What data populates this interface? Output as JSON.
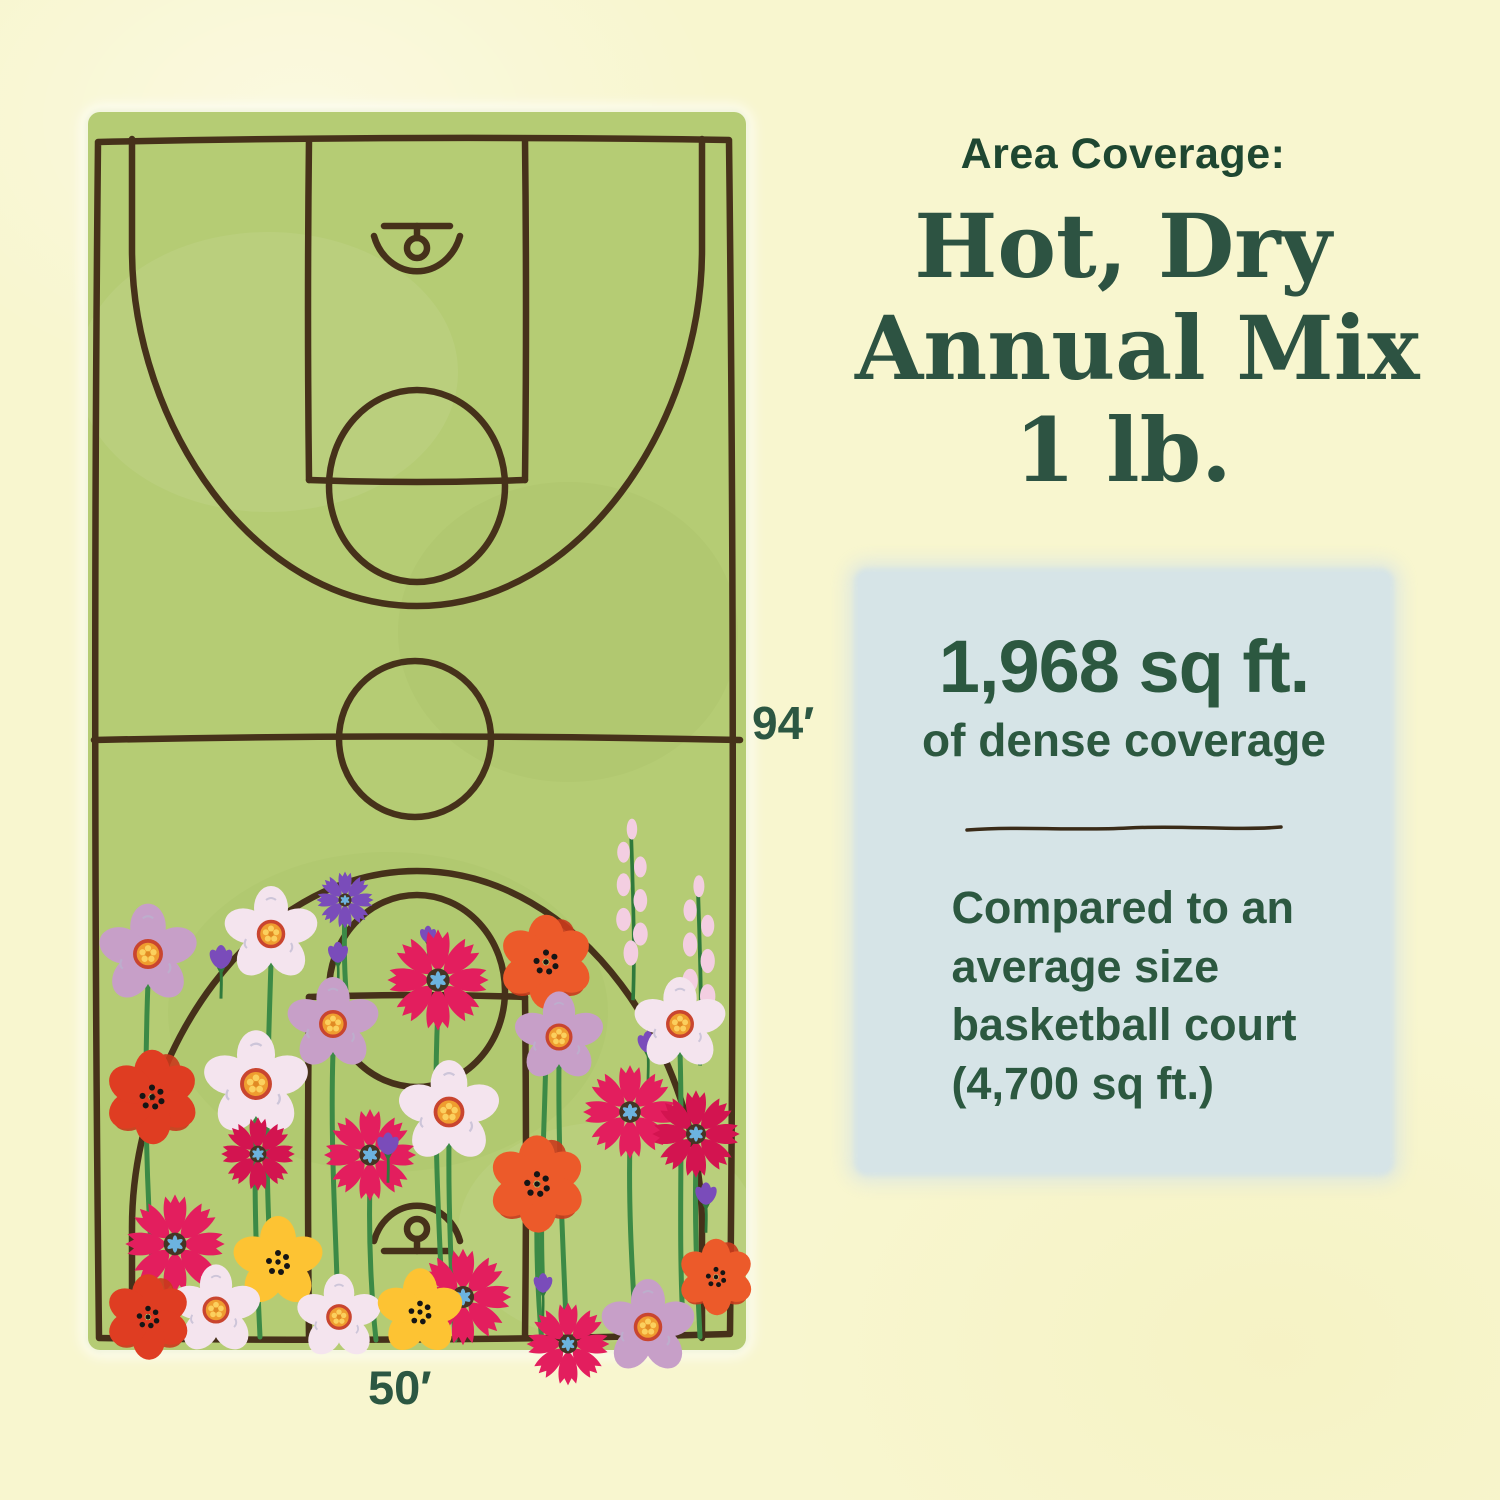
{
  "page": {
    "background_color": "#f8f6cf"
  },
  "left_panel": {
    "illustration": "basketball-court-covered-in-wildflowers",
    "court_length_label": "94′",
    "court_width_label": "50′",
    "court_fill_color": "#b5cc74",
    "court_line_color": "#46311a",
    "flower_palette": [
      "#e31e5e",
      "#d31450",
      "#ec5a2a",
      "#df3d22",
      "#f4e4ee",
      "#c79fc8",
      "#fdc333",
      "#7a4cba",
      "#f3cee1"
    ]
  },
  "right_panel": {
    "eyebrow": "Area Coverage:",
    "title_line1": "Hot, Dry",
    "title_line2": "Annual Mix",
    "title_line3": "1 lb.",
    "title_color": "#2d5342",
    "card": {
      "background_color": "#d6e4e7",
      "headline": "1,968 sq ft.",
      "subheadline": "of dense coverage",
      "comparison_line1": "Compared to an",
      "comparison_line2": "average size",
      "comparison_line3": "basketball court",
      "comparison_line4": "(4,700 sq ft.)"
    }
  }
}
